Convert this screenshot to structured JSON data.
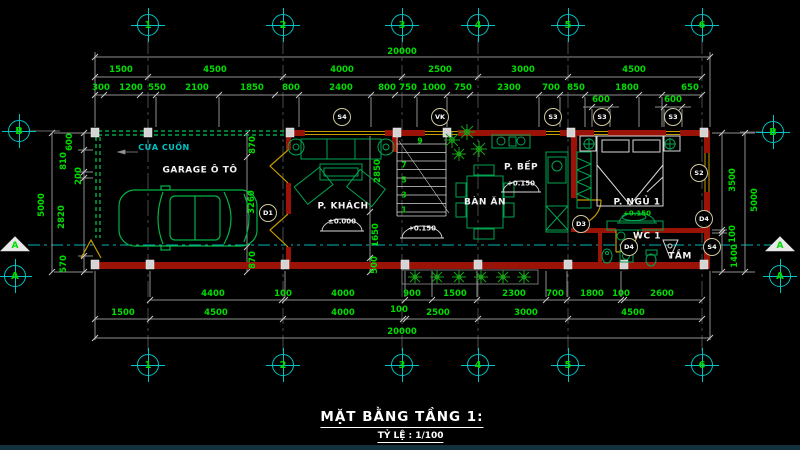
{
  "colors": {
    "bg": "#000000",
    "dim": "#00dc00",
    "cyan": "#00c3c3",
    "wall": "#9b1206",
    "window": "#c79a00",
    "furniture": "#00a550",
    "white": "#d8d8d8",
    "tagborder": "#cfc79e",
    "plant": "#18a018"
  },
  "title": {
    "main": "MẶT BẰNG TẦNG 1:",
    "scale": "TỶ LỆ : 1/100"
  },
  "grid": {
    "bubbles": [
      {
        "t": "1",
        "x": 148,
        "y": 25
      },
      {
        "t": "2",
        "x": 283,
        "y": 25
      },
      {
        "t": "3",
        "x": 402,
        "y": 25
      },
      {
        "t": "4",
        "x": 478,
        "y": 25
      },
      {
        "t": "5",
        "x": 568,
        "y": 25
      },
      {
        "t": "6",
        "x": 702,
        "y": 25
      },
      {
        "t": "1",
        "x": 148,
        "y": 365
      },
      {
        "t": "2",
        "x": 283,
        "y": 365
      },
      {
        "t": "3",
        "x": 402,
        "y": 365
      },
      {
        "t": "4",
        "x": 478,
        "y": 365
      },
      {
        "t": "5",
        "x": 568,
        "y": 365
      },
      {
        "t": "6",
        "x": 702,
        "y": 365
      },
      {
        "t": "B",
        "x": 19,
        "y": 131
      },
      {
        "t": "A",
        "x": 15,
        "y": 276
      },
      {
        "t": "B",
        "x": 773,
        "y": 132
      },
      {
        "t": "A",
        "x": 780,
        "y": 276
      }
    ],
    "arrows": [
      {
        "t": "A",
        "x": 15,
        "y": 243
      },
      {
        "t": "A",
        "x": 780,
        "y": 243
      }
    ]
  },
  "labels": {
    "rooms": [
      {
        "t": "GARAGE Ô TÔ",
        "x": 200,
        "y": 171
      },
      {
        "t": "P. KHÁCH",
        "x": 343,
        "y": 207
      },
      {
        "t": "BÀN ĂN",
        "x": 485,
        "y": 203
      },
      {
        "t": "P. BẾP",
        "x": 521,
        "y": 168
      },
      {
        "t": "P. NGỦ 1",
        "x": 637,
        "y": 203
      },
      {
        "t": "WC 1",
        "x": 647,
        "y": 237
      },
      {
        "t": "TẮM",
        "x": 680,
        "y": 257
      },
      {
        "t": "CỬA CUỐN",
        "x": 164,
        "y": 148,
        "c": "cyan"
      }
    ],
    "levels": [
      {
        "t": "±0.000",
        "x": 342,
        "y": 222
      },
      {
        "t": "+0.150",
        "x": 422,
        "y": 229
      },
      {
        "t": "+0.150",
        "x": 521,
        "y": 184
      },
      {
        "t": "+0.150",
        "x": 637,
        "y": 214,
        "c": "green"
      }
    ],
    "stairs": [
      {
        "t": "1",
        "x": 404,
        "y": 210
      },
      {
        "t": "3",
        "x": 404,
        "y": 195
      },
      {
        "t": "5",
        "x": 404,
        "y": 180
      },
      {
        "t": "7",
        "x": 404,
        "y": 165
      },
      {
        "t": "9",
        "x": 420,
        "y": 141
      }
    ],
    "tags": [
      {
        "t": "S4",
        "x": 342,
        "y": 117
      },
      {
        "t": "VK",
        "x": 440,
        "y": 117
      },
      {
        "t": "S3",
        "x": 553,
        "y": 117
      },
      {
        "t": "S3",
        "x": 602,
        "y": 117
      },
      {
        "t": "S3",
        "x": 673,
        "y": 117
      },
      {
        "t": "D1",
        "x": 268,
        "y": 213
      },
      {
        "t": "D3",
        "x": 581,
        "y": 224
      },
      {
        "t": "S2",
        "x": 699,
        "y": 173
      },
      {
        "t": "D4",
        "x": 704,
        "y": 219
      },
      {
        "t": "D4",
        "x": 629,
        "y": 247
      },
      {
        "t": "S4",
        "x": 712,
        "y": 247
      }
    ]
  },
  "dims": {
    "labels": [
      {
        "t": "20000",
        "x": 402,
        "y": 52
      },
      {
        "t": "1500",
        "x": 121,
        "y": 70
      },
      {
        "t": "4500",
        "x": 215,
        "y": 70
      },
      {
        "t": "4000",
        "x": 342,
        "y": 70
      },
      {
        "t": "2500",
        "x": 440,
        "y": 70
      },
      {
        "t": "3000",
        "x": 523,
        "y": 70
      },
      {
        "t": "4500",
        "x": 634,
        "y": 70
      },
      {
        "t": "300",
        "x": 101,
        "y": 88
      },
      {
        "t": "1200",
        "x": 131,
        "y": 88
      },
      {
        "t": "550",
        "x": 157,
        "y": 88
      },
      {
        "t": "2100",
        "x": 197,
        "y": 88
      },
      {
        "t": "1850",
        "x": 252,
        "y": 88
      },
      {
        "t": "800",
        "x": 291,
        "y": 88
      },
      {
        "t": "2400",
        "x": 341,
        "y": 88
      },
      {
        "t": "800",
        "x": 387,
        "y": 88
      },
      {
        "t": "750",
        "x": 408,
        "y": 88
      },
      {
        "t": "1000",
        "x": 434,
        "y": 88
      },
      {
        "t": "750",
        "x": 463,
        "y": 88
      },
      {
        "t": "2300",
        "x": 509,
        "y": 88
      },
      {
        "t": "700",
        "x": 551,
        "y": 88
      },
      {
        "t": "850",
        "x": 576,
        "y": 88
      },
      {
        "t": "1800",
        "x": 627,
        "y": 88
      },
      {
        "t": "650",
        "x": 690,
        "y": 88
      },
      {
        "t": "600",
        "x": 601,
        "y": 100
      },
      {
        "t": "600",
        "x": 673,
        "y": 100
      },
      {
        "t": "4400",
        "x": 213,
        "y": 294
      },
      {
        "t": "100",
        "x": 283,
        "y": 294
      },
      {
        "t": "4000",
        "x": 343,
        "y": 294
      },
      {
        "t": "900",
        "x": 412,
        "y": 294
      },
      {
        "t": "1500",
        "x": 455,
        "y": 294
      },
      {
        "t": "2300",
        "x": 514,
        "y": 294
      },
      {
        "t": "700",
        "x": 555,
        "y": 294
      },
      {
        "t": "1800",
        "x": 592,
        "y": 294
      },
      {
        "t": "100",
        "x": 621,
        "y": 294
      },
      {
        "t": "2600",
        "x": 662,
        "y": 294
      },
      {
        "t": "1500",
        "x": 123,
        "y": 313
      },
      {
        "t": "4500",
        "x": 216,
        "y": 313
      },
      {
        "t": "4000",
        "x": 343,
        "y": 313
      },
      {
        "t": "100",
        "x": 399,
        "y": 310
      },
      {
        "t": "2500",
        "x": 438,
        "y": 313
      },
      {
        "t": "3000",
        "x": 526,
        "y": 313
      },
      {
        "t": "4500",
        "x": 633,
        "y": 313
      },
      {
        "t": "20000",
        "x": 402,
        "y": 332
      },
      {
        "t": "5000",
        "x": 42,
        "y": 205,
        "rot": 1
      },
      {
        "t": "600",
        "x": 70,
        "y": 142,
        "rot": 1
      },
      {
        "t": "810",
        "x": 64,
        "y": 161,
        "rot": 1
      },
      {
        "t": "200",
        "x": 79,
        "y": 176,
        "rot": 1
      },
      {
        "t": "2820",
        "x": 62,
        "y": 217,
        "rot": 1
      },
      {
        "t": "570",
        "x": 64,
        "y": 264,
        "rot": 1
      },
      {
        "t": "3500",
        "x": 733,
        "y": 180,
        "rot": 1
      },
      {
        "t": "5000",
        "x": 755,
        "y": 200,
        "rot": 1
      },
      {
        "t": "100",
        "x": 733,
        "y": 234,
        "rot": 1
      },
      {
        "t": "1400",
        "x": 735,
        "y": 256,
        "rot": 1
      },
      {
        "t": "870",
        "x": 253,
        "y": 145,
        "rot": 1
      },
      {
        "t": "3260",
        "x": 252,
        "y": 202,
        "rot": 1
      },
      {
        "t": "870",
        "x": 253,
        "y": 260,
        "rot": 1
      },
      {
        "t": "2850",
        "x": 378,
        "y": 171,
        "rot": 1
      },
      {
        "t": "1650",
        "x": 376,
        "y": 235,
        "rot": 1
      },
      {
        "t": "500",
        "x": 375,
        "y": 265,
        "rot": 1
      }
    ]
  }
}
